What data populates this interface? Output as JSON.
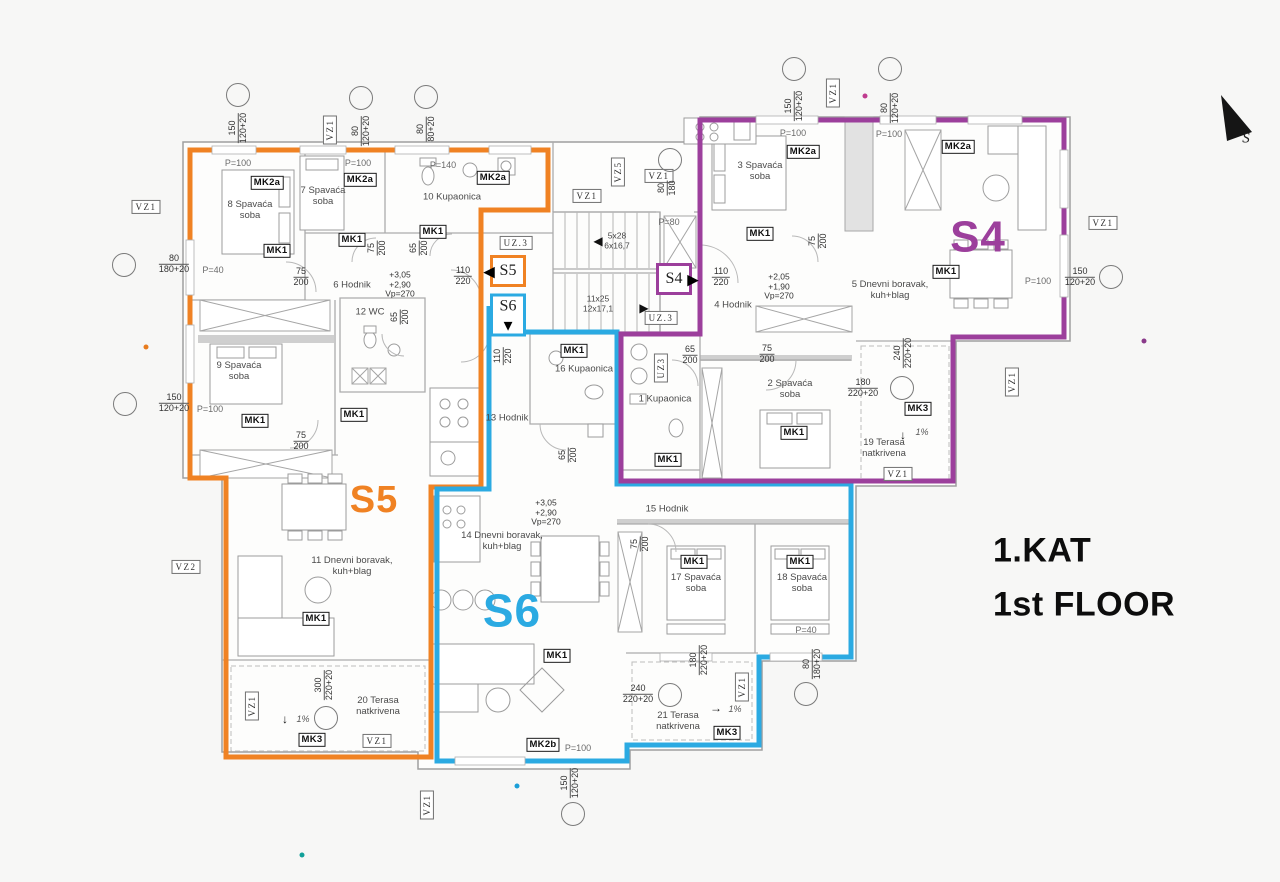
{
  "meta": {
    "floor_title": "1.KAT\n1st FLOOR",
    "north_label": "S"
  },
  "apartments": [
    {
      "id": "S4",
      "color": "#9c3f9c"
    },
    {
      "id": "S5",
      "color": "#f08223"
    },
    {
      "id": "S6",
      "color": "#2baae2"
    }
  ],
  "labels": [
    {
      "t": "150\n120+20",
      "x": 238,
      "y": 128,
      "c": "dim",
      "r": -90
    },
    {
      "t": "VZ1",
      "x": 330,
      "y": 130,
      "c": "vz",
      "r": -90
    },
    {
      "t": "80\n120+20",
      "x": 361,
      "y": 131,
      "c": "dim",
      "r": -90
    },
    {
      "t": "80\n80+20",
      "x": 426,
      "y": 129,
      "c": "dim",
      "r": -90
    },
    {
      "t": "150\n120+20",
      "x": 794,
      "y": 106,
      "c": "dim",
      "r": -90
    },
    {
      "t": "VZ1",
      "x": 833,
      "y": 93,
      "c": "vz",
      "r": -90
    },
    {
      "t": "80\n120+20",
      "x": 890,
      "y": 108,
      "c": "dim",
      "r": -90
    },
    {
      "t": "VZ1",
      "x": 146,
      "y": 207,
      "c": "vz"
    },
    {
      "t": "80\n180+20",
      "x": 174,
      "y": 264,
      "c": "dim"
    },
    {
      "t": "P=40",
      "x": 213,
      "y": 270,
      "c": "p"
    },
    {
      "t": "150\n120+20",
      "x": 174,
      "y": 403,
      "c": "dim"
    },
    {
      "t": "P=100",
      "x": 210,
      "y": 409,
      "c": "p"
    },
    {
      "t": "VZ2",
      "x": 186,
      "y": 567,
      "c": "vz"
    },
    {
      "t": "VZ1",
      "x": 252,
      "y": 706,
      "c": "vz",
      "r": -90
    },
    {
      "t": "VZ1",
      "x": 1103,
      "y": 223,
      "c": "vz"
    },
    {
      "t": "150\n120+20",
      "x": 1080,
      "y": 277,
      "c": "dim"
    },
    {
      "t": "P=100",
      "x": 1038,
      "y": 281,
      "c": "p"
    },
    {
      "t": "VZ1",
      "x": 1012,
      "y": 382,
      "c": "vz",
      "r": -90
    },
    {
      "t": "VZ1",
      "x": 427,
      "y": 805,
      "c": "vz",
      "r": -90
    },
    {
      "t": "150\n120+20",
      "x": 570,
      "y": 783,
      "c": "dim",
      "r": -90
    },
    {
      "t": "P=100",
      "x": 238,
      "y": 163,
      "c": "p"
    },
    {
      "t": "P=100",
      "x": 358,
      "y": 163,
      "c": "p"
    },
    {
      "t": "P=140",
      "x": 443,
      "y": 165,
      "c": "p"
    },
    {
      "t": "MK2a",
      "x": 267,
      "y": 183,
      "c": "mk"
    },
    {
      "t": "MK2a",
      "x": 360,
      "y": 180,
      "c": "mk"
    },
    {
      "t": "MK2a",
      "x": 493,
      "y": 178,
      "c": "mk"
    },
    {
      "t": "8 Spavaća\nsoba",
      "x": 250,
      "y": 211,
      "c": "room"
    },
    {
      "t": "7 Spavaća\nsoba",
      "x": 323,
      "y": 197,
      "c": "room"
    },
    {
      "t": "10 Kupaonica",
      "x": 452,
      "y": 198,
      "c": "room"
    },
    {
      "t": "MK1",
      "x": 277,
      "y": 251,
      "c": "mk"
    },
    {
      "t": "MK1",
      "x": 352,
      "y": 240,
      "c": "mk"
    },
    {
      "t": "MK1",
      "x": 433,
      "y": 232,
      "c": "mk"
    },
    {
      "t": "75\n200",
      "x": 377,
      "y": 248,
      "c": "dim",
      "r": -90
    },
    {
      "t": "65\n200",
      "x": 419,
      "y": 248,
      "c": "dim",
      "r": -90
    },
    {
      "t": "UZ.3",
      "x": 516,
      "y": 243,
      "c": "vz"
    },
    {
      "t": "75\n200",
      "x": 301,
      "y": 277,
      "c": "dim"
    },
    {
      "t": "6 Hodnik",
      "x": 352,
      "y": 286,
      "c": "room"
    },
    {
      "t": "+3,05\n+2,90\nVp=270",
      "x": 400,
      "y": 285,
      "c": "lvl"
    },
    {
      "t": "110\n220",
      "x": 463,
      "y": 276,
      "c": "dim"
    },
    {
      "t": "12 WC",
      "x": 370,
      "y": 313,
      "c": "room"
    },
    {
      "t": "65\n200",
      "x": 400,
      "y": 317,
      "c": "dim",
      "r": -90
    },
    {
      "t": "9 Spavaća\nsoba",
      "x": 239,
      "y": 372,
      "c": "room"
    },
    {
      "t": "MK1",
      "x": 255,
      "y": 421,
      "c": "mk"
    },
    {
      "t": "75\n200",
      "x": 301,
      "y": 441,
      "c": "dim"
    },
    {
      "t": "MK1",
      "x": 354,
      "y": 415,
      "c": "mk"
    },
    {
      "t": "13 Hodnik",
      "x": 507,
      "y": 419,
      "c": "room"
    },
    {
      "t": "110\n220",
      "x": 503,
      "y": 356,
      "c": "dim",
      "r": -90
    },
    {
      "t": "S5",
      "x": 374,
      "y": 501,
      "c": "big5",
      "n": "apartment-letter-s5"
    },
    {
      "t": "11 Dnevni boravak,\nkuh+blag",
      "x": 352,
      "y": 567,
      "c": "room"
    },
    {
      "t": "MK1",
      "x": 316,
      "y": 619,
      "c": "mk"
    },
    {
      "t": "300\n220+20",
      "x": 324,
      "y": 685,
      "c": "dim",
      "r": -90
    },
    {
      "t": "20 Terasa\nnatkrivena",
      "x": 378,
      "y": 707,
      "c": "room"
    },
    {
      "t": "1%",
      "x": 303,
      "y": 719,
      "c": "pct"
    },
    {
      "t": "↓",
      "x": 285,
      "y": 720,
      "c": "arr"
    },
    {
      "t": "MK3",
      "x": 312,
      "y": 740,
      "c": "mk"
    },
    {
      "t": "VZ1",
      "x": 377,
      "y": 741,
      "c": "vz"
    },
    {
      "t": "5x28\n6x16,7",
      "x": 617,
      "y": 241,
      "c": "stair"
    },
    {
      "t": "◀",
      "x": 598,
      "y": 242,
      "c": "arr"
    },
    {
      "t": "P=80",
      "x": 669,
      "y": 222,
      "c": "p"
    },
    {
      "t": "11x25\n12x17,1",
      "x": 598,
      "y": 304,
      "c": "stair"
    },
    {
      "t": "▶",
      "x": 644,
      "y": 309,
      "c": "arr"
    },
    {
      "t": "UZ.3",
      "x": 661,
      "y": 318,
      "c": "vz"
    },
    {
      "t": "VZ5",
      "x": 618,
      "y": 172,
      "c": "vz",
      "r": -90
    },
    {
      "t": "VZ1",
      "x": 587,
      "y": 196,
      "c": "vz"
    },
    {
      "t": "VZ1",
      "x": 659,
      "y": 176,
      "c": "vz"
    },
    {
      "t": "80\n180",
      "x": 667,
      "y": 188,
      "c": "dim",
      "r": -90
    },
    {
      "t": "S5",
      "x": 508,
      "y": 271,
      "c": "entry e5",
      "n": "entry-marker-s5"
    },
    {
      "t": "◀",
      "x": 489,
      "y": 272,
      "c": "arrbig",
      "n": "entry-arrow-s5"
    },
    {
      "t": "S6",
      "x": 508,
      "y": 315,
      "c": "entry e6",
      "n": "entry-marker-s6"
    },
    {
      "t": "▼",
      "x": 508,
      "y": 326,
      "c": "arrbig",
      "n": "entry-arrow-s6"
    },
    {
      "t": "S4",
      "x": 674,
      "y": 279,
      "c": "entry e4",
      "n": "entry-marker-s4"
    },
    {
      "t": "▶",
      "x": 693,
      "y": 280,
      "c": "arrbig",
      "n": "entry-arrow-s4"
    },
    {
      "t": "110\n220",
      "x": 721,
      "y": 277,
      "c": "dim"
    },
    {
      "t": "+2,05\n+1,90\nVp=270",
      "x": 779,
      "y": 287,
      "c": "lvl"
    },
    {
      "t": "4 Hodnik",
      "x": 733,
      "y": 306,
      "c": "room"
    },
    {
      "t": "P=100",
      "x": 793,
      "y": 133,
      "c": "p"
    },
    {
      "t": "P=100",
      "x": 889,
      "y": 134,
      "c": "p"
    },
    {
      "t": "MK2a",
      "x": 803,
      "y": 152,
      "c": "mk"
    },
    {
      "t": "MK2a",
      "x": 958,
      "y": 147,
      "c": "mk"
    },
    {
      "t": "3 Spavaća\nsoba",
      "x": 760,
      "y": 172,
      "c": "room"
    },
    {
      "t": "MK1",
      "x": 760,
      "y": 234,
      "c": "mk"
    },
    {
      "t": "75\n200",
      "x": 818,
      "y": 241,
      "c": "dim",
      "r": -90
    },
    {
      "t": "S4",
      "x": 978,
      "y": 238,
      "c": "big4",
      "n": "apartment-letter-s4"
    },
    {
      "t": "5 Dnevni boravak,\nkuh+blag",
      "x": 890,
      "y": 291,
      "c": "room"
    },
    {
      "t": "MK1",
      "x": 946,
      "y": 272,
      "c": "mk"
    },
    {
      "t": "65\n200",
      "x": 690,
      "y": 355,
      "c": "dim"
    },
    {
      "t": "75\n200",
      "x": 767,
      "y": 354,
      "c": "dim"
    },
    {
      "t": "UZ3",
      "x": 661,
      "y": 368,
      "c": "vz",
      "r": -90
    },
    {
      "t": "1 Kupaonica",
      "x": 665,
      "y": 400,
      "c": "room"
    },
    {
      "t": "2 Spavaća\nsoba",
      "x": 790,
      "y": 390,
      "c": "room"
    },
    {
      "t": "MK1",
      "x": 794,
      "y": 433,
      "c": "mk"
    },
    {
      "t": "MK1",
      "x": 668,
      "y": 460,
      "c": "mk"
    },
    {
      "t": "180\n220+20",
      "x": 863,
      "y": 388,
      "c": "dim"
    },
    {
      "t": "240\n220+20",
      "x": 903,
      "y": 353,
      "c": "dim",
      "r": -90
    },
    {
      "t": "MK3",
      "x": 918,
      "y": 409,
      "c": "mk"
    },
    {
      "t": "1%",
      "x": 922,
      "y": 432,
      "c": "pct"
    },
    {
      "t": "↓",
      "x": 903,
      "y": 436,
      "c": "arr"
    },
    {
      "t": "19 Terasa\nnatkrivena",
      "x": 884,
      "y": 449,
      "c": "room"
    },
    {
      "t": "VZ1",
      "x": 898,
      "y": 474,
      "c": "vz"
    },
    {
      "t": "MK1",
      "x": 574,
      "y": 351,
      "c": "mk"
    },
    {
      "t": "16 Kupaonica",
      "x": 584,
      "y": 370,
      "c": "room"
    },
    {
      "t": "65\n200",
      "x": 568,
      "y": 455,
      "c": "dim",
      "r": -90
    },
    {
      "t": "S6",
      "x": 512,
      "y": 611,
      "c": "big6",
      "n": "apartment-letter-s6"
    },
    {
      "t": "+3,05\n+2,90\nVp=270",
      "x": 546,
      "y": 513,
      "c": "lvl"
    },
    {
      "t": "14 Dnevni boravak,\nkuh+blag",
      "x": 502,
      "y": 542,
      "c": "room"
    },
    {
      "t": "MK1",
      "x": 557,
      "y": 656,
      "c": "mk"
    },
    {
      "t": "15 Hodnik",
      "x": 667,
      "y": 510,
      "c": "room"
    },
    {
      "t": "75\n200",
      "x": 640,
      "y": 544,
      "c": "dim",
      "r": -90
    },
    {
      "t": "MK1",
      "x": 694,
      "y": 562,
      "c": "mk"
    },
    {
      "t": "17 Spavaća\nsoba",
      "x": 696,
      "y": 584,
      "c": "room"
    },
    {
      "t": "MK1",
      "x": 800,
      "y": 562,
      "c": "mk"
    },
    {
      "t": "18 Spavaća\nsoba",
      "x": 802,
      "y": 584,
      "c": "room"
    },
    {
      "t": "P=40",
      "x": 806,
      "y": 630,
      "c": "p"
    },
    {
      "t": "180\n220+20",
      "x": 699,
      "y": 660,
      "c": "dim",
      "r": -90
    },
    {
      "t": "80\n180+20",
      "x": 812,
      "y": 664,
      "c": "dim",
      "r": -90
    },
    {
      "t": "240\n220+20",
      "x": 638,
      "y": 694,
      "c": "dim"
    },
    {
      "t": "21 Terasa\nnatkrivena",
      "x": 678,
      "y": 722,
      "c": "room"
    },
    {
      "t": "1%",
      "x": 735,
      "y": 709,
      "c": "pct"
    },
    {
      "t": "→",
      "x": 716,
      "y": 709,
      "c": "arr"
    },
    {
      "t": "MK3",
      "x": 727,
      "y": 733,
      "c": "mk"
    },
    {
      "t": "VZ1",
      "x": 742,
      "y": 687,
      "c": "vz",
      "r": -90
    },
    {
      "t": "MK2b",
      "x": 543,
      "y": 745,
      "c": "mk"
    },
    {
      "t": "P=100",
      "x": 578,
      "y": 748,
      "c": "p"
    },
    {
      "t": "S",
      "x": 1246,
      "y": 139,
      "c": "norths",
      "n": "north-label"
    }
  ],
  "dim_bubbles": [
    {
      "x": 238,
      "y": 95
    },
    {
      "x": 361,
      "y": 98
    },
    {
      "x": 426,
      "y": 97
    },
    {
      "x": 794,
      "y": 69
    },
    {
      "x": 890,
      "y": 69
    },
    {
      "x": 124,
      "y": 265
    },
    {
      "x": 125,
      "y": 404
    },
    {
      "x": 1111,
      "y": 277
    },
    {
      "x": 573,
      "y": 814
    },
    {
      "x": 670,
      "y": 160
    },
    {
      "x": 902,
      "y": 388
    },
    {
      "x": 670,
      "y": 695
    },
    {
      "x": 806,
      "y": 694
    },
    {
      "x": 326,
      "y": 718
    }
  ],
  "dots": [
    {
      "x": 146,
      "y": 347,
      "color": "#e87c1e"
    },
    {
      "x": 865,
      "y": 96,
      "color": "#bf3b8f"
    },
    {
      "x": 1144,
      "y": 341,
      "color": "#8a3a8a"
    },
    {
      "x": 517,
      "y": 786,
      "color": "#1b9fd8"
    },
    {
      "x": 302,
      "y": 855,
      "color": "#11a099"
    }
  ]
}
